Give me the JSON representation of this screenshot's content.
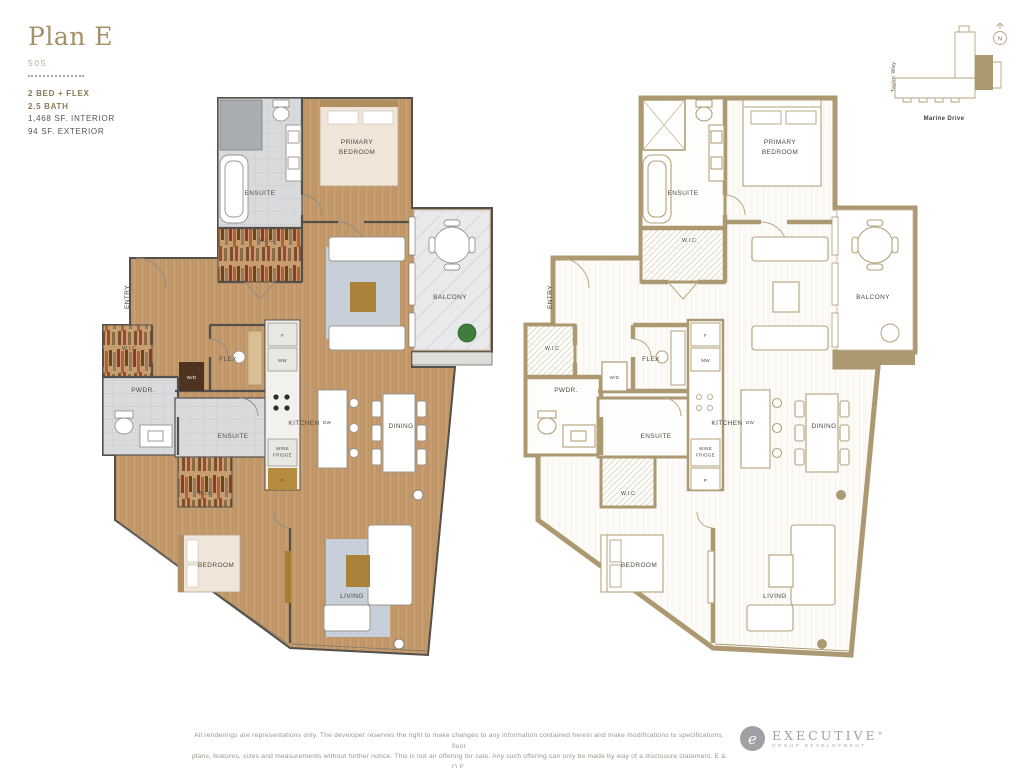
{
  "header": {
    "title": "Plan E",
    "unit_number": "505",
    "spec_beds": "2 BED + FLEX",
    "spec_bath": "2.5 BATH",
    "spec_interior": "1,468 SF. INTERIOR",
    "spec_exterior": "94 SF. EXTERIOR"
  },
  "site_map": {
    "street_left": "Taylor Way",
    "street_bottom": "Marine Drive",
    "compass": "N"
  },
  "rooms": {
    "primary_bedroom_line1": "PRIMARY",
    "primary_bedroom_line2": "BEDROOM",
    "ensuite": "ENSUITE",
    "wic": "W.I.C.",
    "balcony": "BALCONY",
    "entry": "ENTRY",
    "pwdr": "PWDR.",
    "wd": "W/D",
    "flex": "FLEX",
    "fridge": "F",
    "microwave": "MW",
    "kitchen": "KITCHEN",
    "dishwasher": "DW",
    "wine_fridge_line1": "WINE",
    "wine_fridge_line2": "FRIDGE",
    "pantry": "P",
    "dining": "DINING",
    "bedroom": "BEDROOM",
    "living": "LIVING"
  },
  "footer": {
    "disclaimer_line1": "All renderings are representations only. The developer reserves the right to make changes to any information contained herein and make modifications to specifications, floor",
    "disclaimer_line2": "plans, features, sizes and measurements without further notice. This is not an offering for sale. Any such offering can only be made by way of a disclosure statement. E & O.E.",
    "logo_monogram": "e",
    "logo_name": "Executive",
    "logo_registered": "®",
    "logo_tagline": "Group Development"
  },
  "colors": {
    "accent_gold": "#A5906A",
    "wall_tan": "#AC9971",
    "wood_floor": "#C89F70",
    "tile_gray": "#D8DADC",
    "label_text": "#4C4B45"
  }
}
